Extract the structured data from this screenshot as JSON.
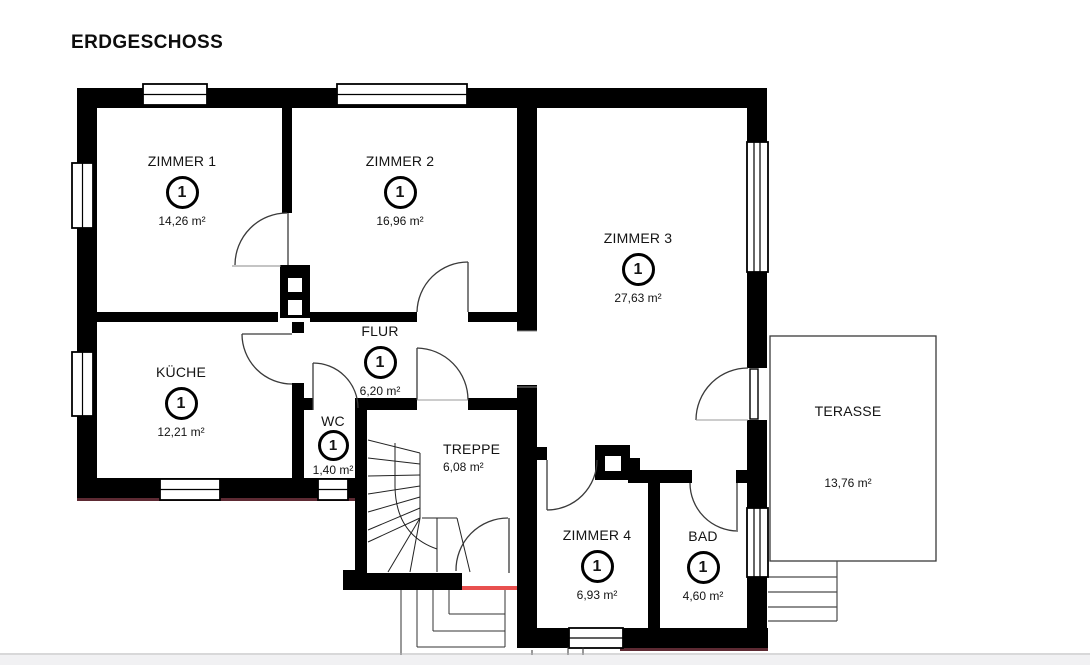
{
  "page": {
    "title": "ERDGESCHOSS",
    "background": "#ffffff",
    "wall_color": "#000000",
    "threshold_red": "#e8504f"
  },
  "floorplan": {
    "rooms": [
      {
        "id": "zimmer1",
        "name": "ZIMMER 1",
        "marker": "1",
        "area": "14,26 m²"
      },
      {
        "id": "zimmer2",
        "name": "ZIMMER 2",
        "marker": "1",
        "area": "16,96 m²"
      },
      {
        "id": "zimmer3",
        "name": "ZIMMER 3",
        "marker": "1",
        "area": "27,63 m²"
      },
      {
        "id": "kueche",
        "name": "KÜCHE",
        "marker": "1",
        "area": "12,21 m²"
      },
      {
        "id": "flur",
        "name": "FLUR",
        "marker": "1",
        "area": "6,20 m²"
      },
      {
        "id": "wc",
        "name": "WC",
        "marker": "1",
        "area": "1,40 m²"
      },
      {
        "id": "treppe",
        "name": "TREPPE",
        "marker": null,
        "area": "6,08 m²"
      },
      {
        "id": "zimmer4",
        "name": "ZIMMER 4",
        "marker": "1",
        "area": "6,93 m²"
      },
      {
        "id": "bad",
        "name": "BAD",
        "marker": "1",
        "area": "4,60 m²"
      },
      {
        "id": "terasse",
        "name": "TERASSE",
        "marker": null,
        "area": "13,76 m²"
      }
    ]
  }
}
